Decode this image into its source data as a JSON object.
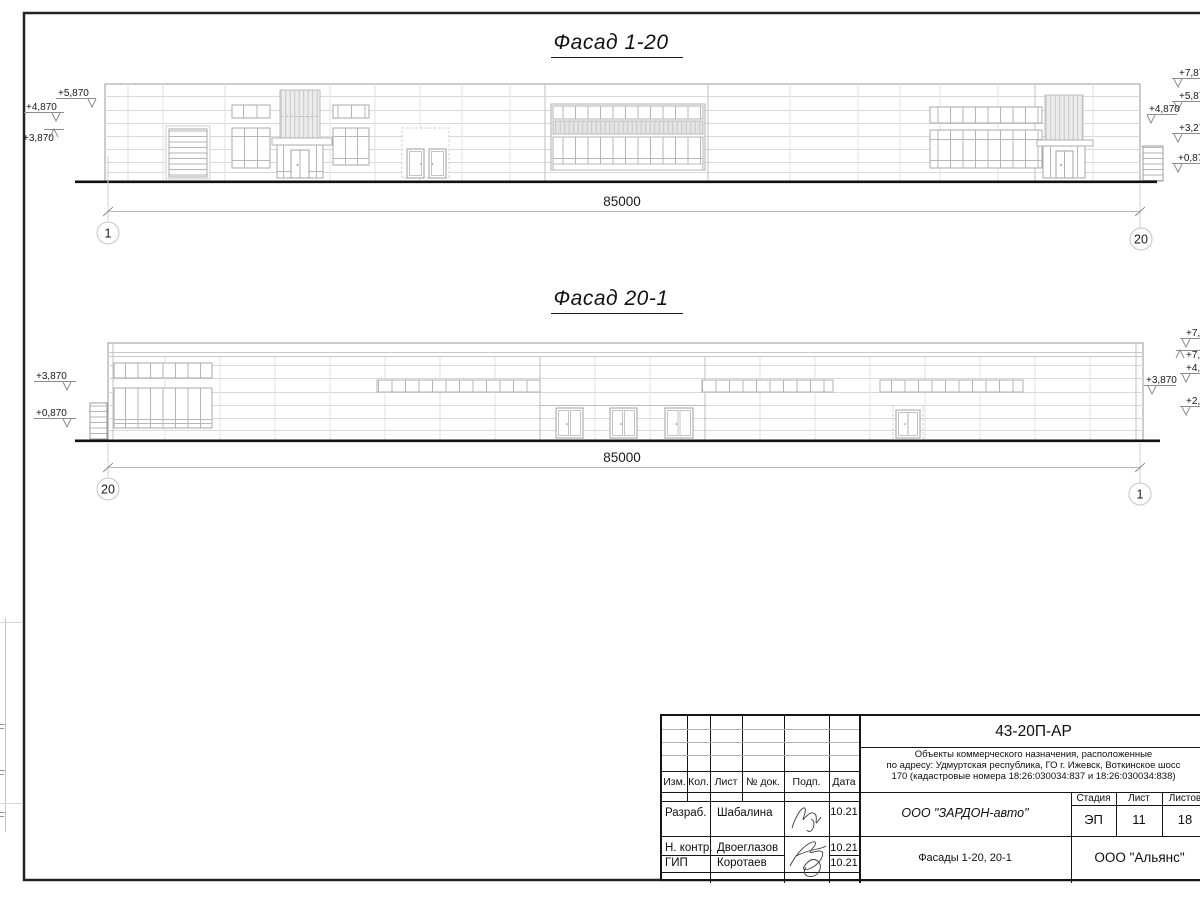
{
  "colors": {
    "line_dark": "#161616",
    "line_medium": "#999999",
    "line_light": "#dcdcdc"
  },
  "facade1": {
    "title": "Фасад 1-20",
    "dimension": "85000",
    "axis_left": "1",
    "axis_right": "20",
    "elev_left": [
      "+5,870",
      "+4,870",
      "+3,870"
    ],
    "elev_right": [
      "+7,87",
      "+5,87",
      "+4,870",
      "+3,27",
      "+0,87"
    ]
  },
  "facade2": {
    "title": "Фасад 20-1",
    "dimension": "85000",
    "axis_left": "20",
    "axis_right": "1",
    "elev_left": [
      "+3,870",
      "+0,870"
    ],
    "elev_right": [
      "+7,8",
      "+7,",
      "+4,8",
      "+3,870",
      "+2,1"
    ]
  },
  "title_block": {
    "doc_code": "43-20П-АР",
    "desc1": "Объекты коммерческого назначения, расположенные",
    "desc2": "по адресу: Удмуртская республика, ГО г. Ижевск, Воткинское шосс",
    "desc3": "170 (кадастровые номера 18:26:030034:837 и 18:26:030034:838)",
    "columns": {
      "izm": "Изм.",
      "kol": "Кол.",
      "list": "Лист",
      "doc": "№ док.",
      "podp": "Подп.",
      "data": "Дата"
    },
    "rows": [
      {
        "role": "Разраб.",
        "name": "Шабалина",
        "date": "10.21"
      },
      {
        "role": "Н. контр.",
        "name": "Двоеглазов",
        "date": "10.21"
      },
      {
        "role": "ГИП",
        "name": "Коротаев",
        "date": "10.21"
      }
    ],
    "org": "ООО \"ЗАРДОН-авто\"",
    "doc_title": "Фасады 1-20, 20-1",
    "stage_label": "Стадия",
    "sheet_label": "Лист",
    "sheets_label": "Листов",
    "stage": "ЭП",
    "sheet_no": "11",
    "sheets_total": "18",
    "firm": "ООО \"Альянс\""
  }
}
